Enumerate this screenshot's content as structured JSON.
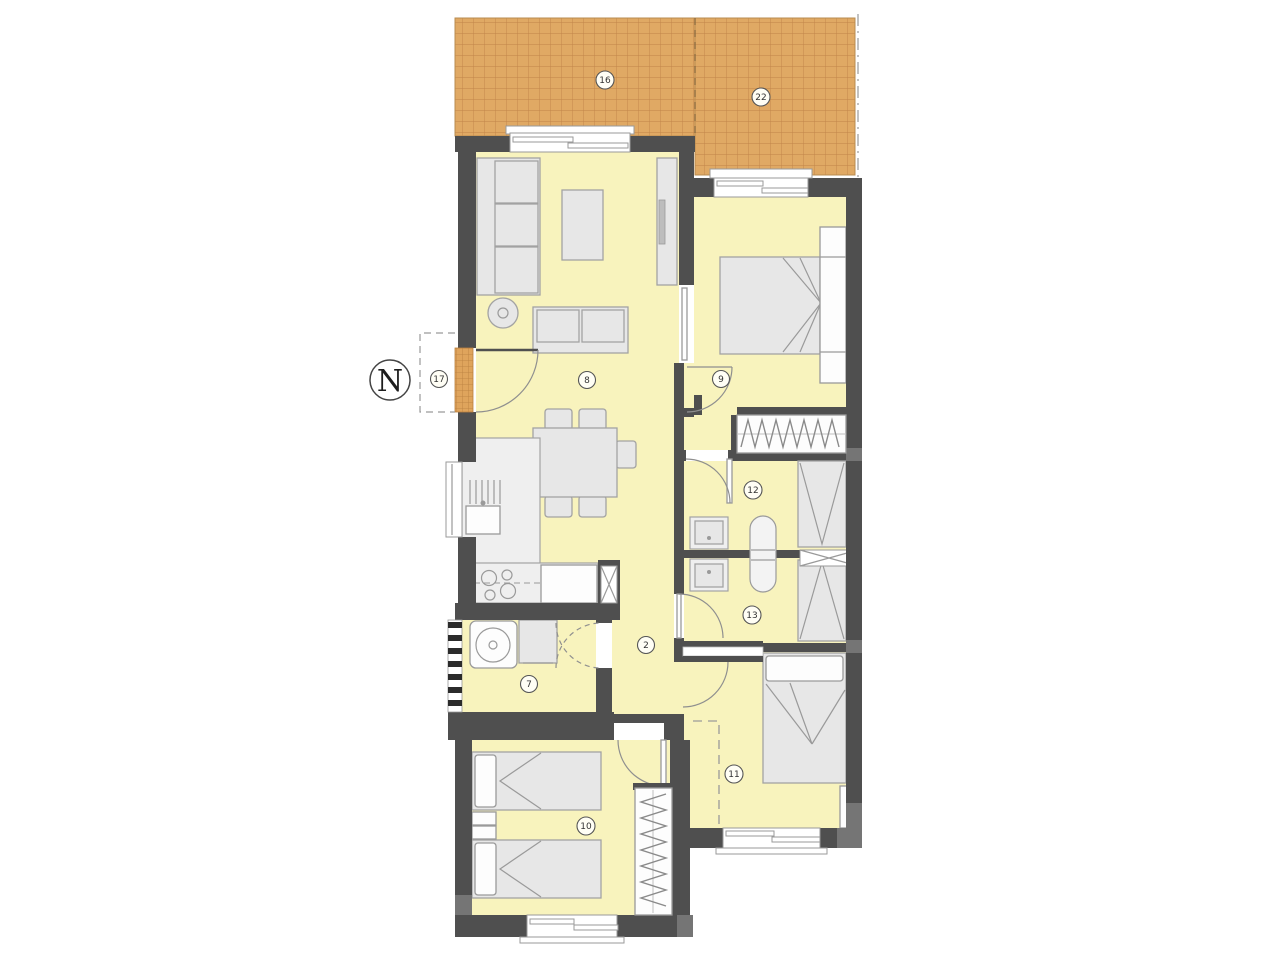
{
  "plan": {
    "type": "apartment-floor-plan",
    "compass": "N",
    "labels": {
      "terrace_left": "16",
      "terrace_right": "22",
      "entrance": "17",
      "living_room": "8",
      "bedroom_main": "9",
      "bathroom_top": "12",
      "bathroom_bottom": "13",
      "hallway": "2",
      "utility": "7",
      "bedroom_bottom_left": "10",
      "bedroom_bottom_right": "11"
    },
    "colors": {
      "wall": "#4f4f4f",
      "wall_pillar": "#757575",
      "room_fill": "#f8f3bd",
      "terrace_fill": "#e0a964",
      "terrace_grid": "#c08448",
      "furniture_fill": "#e7e7e7",
      "furniture_outline": "#9a9a9a",
      "background": "#ffffff"
    }
  }
}
